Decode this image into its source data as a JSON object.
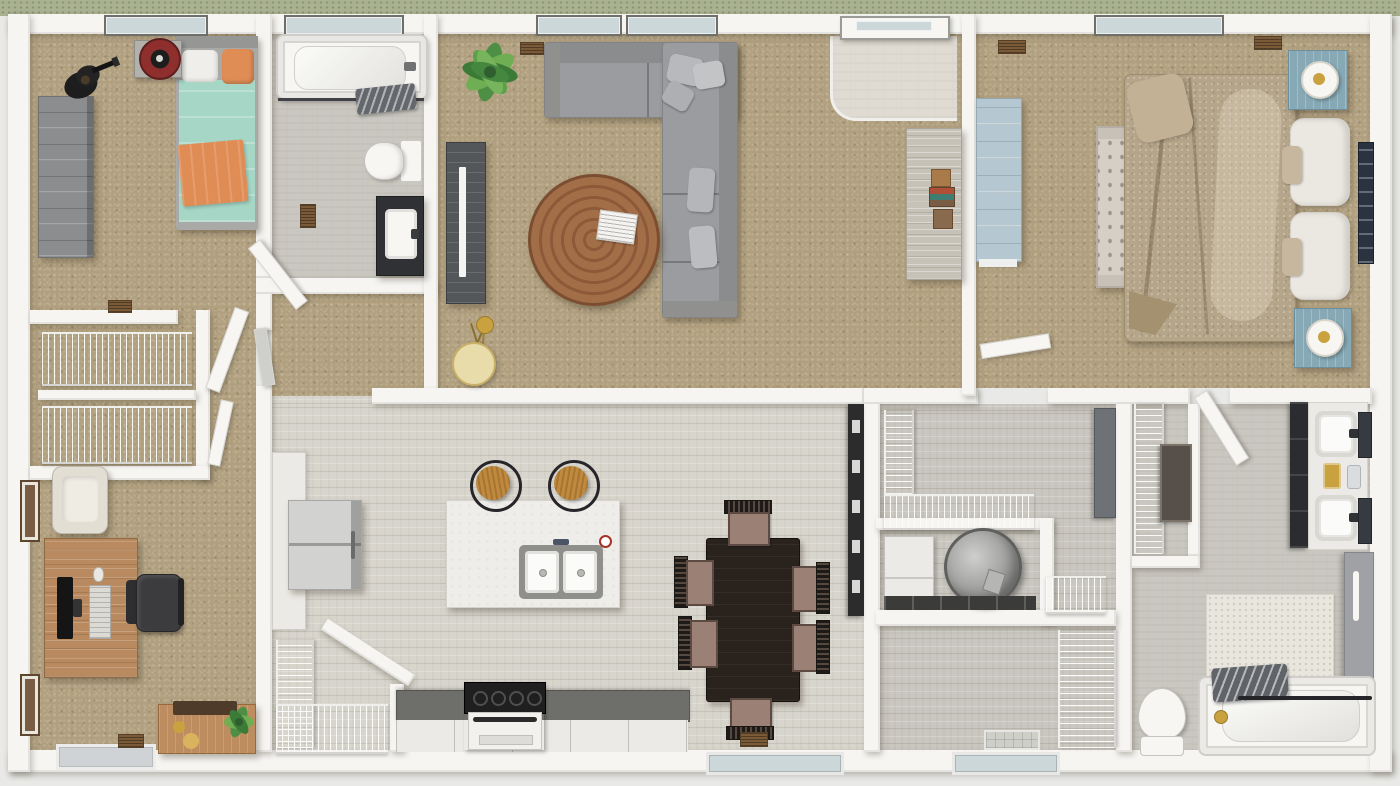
{
  "scene": {
    "kind": "3d-floor-plan-rendering",
    "view": "top-down",
    "note": "single-story residential floor plan, photorealistic dollhouse view, no visible text labels"
  },
  "palette": {
    "surround": "#e9e9e7",
    "grass": "#a9b190",
    "wall": "#f6f5f2",
    "wall_edge": "#c9c7c2",
    "carpet": "#b1a07f",
    "wood_light": "#d8d5cd",
    "wood_gray": "#cac7c0",
    "wood_entry": "#dfdbd2",
    "glass": "#ccd7d9",
    "vent": "#7b5a38",
    "sofa": "#9b9c9f",
    "sofa_back": "#8b8c8e",
    "pillow": "#b8b9bc",
    "coffee_table": "#a26e48",
    "coffee_table_ring": "#8d5a39",
    "tv_console": "#54575a",
    "tv": "#f4f4f2",
    "lamp_gold": "#c9a23f",
    "lamp_shade": "#e9dcab",
    "sofa_table": "#c6c2b8",
    "teal": "#a5d6c6",
    "orange": "#e08c55",
    "bed_frame": "#a9aaa8",
    "dresser_gray": "#8b8d8f",
    "speaker_red": "#8e2f2e",
    "bed_tan": "#b5a58a",
    "bed_fold": "#a3916f",
    "headboard_white": "#ebe8e1",
    "bench": "#d5cfc6",
    "nightstand": "#87a9b6",
    "dresser_blue": "#b5c8d1",
    "art_navy": "#2b3340",
    "island": "#efede9",
    "sink_rim": "#8f908c",
    "counter_dark": "#6e6f6a",
    "cabinet_white": "#eceae6",
    "stool_wood": "#c08a3e",
    "fridge": "#d2d2d0",
    "range_black": "#1f1f1f",
    "dining_table": "#2a231d",
    "chair_seat": "#9b8076",
    "chair_frame": "#3a322c",
    "dark_cabinet": "#2c2c2c",
    "appliance": "#eceae7",
    "heater": "#a7a7a5",
    "pan_dark": "#3b3b39",
    "gray_door": "#6e7176",
    "gray_panel": "#9fa1a4",
    "fixture_white": "#f7f6f3",
    "mat_white": "#e9e6de",
    "curtain": "#85898e",
    "desk_wood": "#b98a5f",
    "office_chair": "#3c3c3e",
    "armchair": "#e2ded4",
    "console_wood": "#bd8d60",
    "frame_brown": "#7a5b43",
    "plant_dark": "#3c7a38",
    "plant_light": "#6fae52"
  },
  "rooms": [
    {
      "id": "bedroom-2",
      "floor": "carpet",
      "contents": [
        "twin-bed-teal",
        "orange-pillows",
        "gray-dresser",
        "speaker-on-stand",
        "guitar",
        "window"
      ]
    },
    {
      "id": "hall-bathroom",
      "floor": "gray-wood",
      "contents": [
        "bathtub",
        "hanging-towels",
        "toilet",
        "dark-vanity-sink",
        "floor-vent",
        "door"
      ]
    },
    {
      "id": "hallway-closets",
      "floor": "carpet",
      "contents": [
        "wire-shelf-closet-upper",
        "wire-shelf-closet-lower",
        "doors"
      ]
    },
    {
      "id": "office-bedroom-3",
      "floor": "carpet",
      "contents": [
        "desk",
        "monitor",
        "keyboard",
        "office-chair",
        "armchair",
        "wall-frames",
        "console-with-plant",
        "door-mat",
        "floor-vent"
      ]
    },
    {
      "id": "living-room",
      "floor": "carpet",
      "contents": [
        "sectional-sofa",
        "round-coffee-table",
        "magazine",
        "tv-console",
        "tv",
        "potted-plant",
        "tripod-floor-lamp",
        "sofa-table",
        "entry-tile",
        "front-door",
        "windows"
      ]
    },
    {
      "id": "primary-bedroom",
      "floor": "carpet",
      "contents": [
        "king-bed-tan",
        "white-headboard-pillows",
        "tufted-bench",
        "blue-nightstands",
        "table-lamps",
        "blue-dresser",
        "wall-art",
        "window",
        "floor-vents",
        "door"
      ]
    },
    {
      "id": "kitchen-dining",
      "floor": "light-wood",
      "contents": [
        "island-double-sink",
        "bar-stools",
        "fridge",
        "range",
        "counter-run",
        "pantry-wire-shelves",
        "tall-dark-cabinet",
        "dining-table",
        "six-chairs",
        "back-door",
        "floor-vent"
      ]
    },
    {
      "id": "laundry-utility",
      "floor": "gray-wood",
      "contents": [
        "wire-shelves",
        "washer",
        "water-heater",
        "drain-pan",
        "gray-door-panel"
      ]
    },
    {
      "id": "mudroom-hall",
      "floor": "gray-wood",
      "contents": [
        "wire-shelf-closet",
        "exterior-door-threshold"
      ]
    },
    {
      "id": "primary-bathroom",
      "floor": "gray-wood",
      "contents": [
        "double-vanity",
        "two-sinks",
        "mirrors",
        "toiletry-tray",
        "walk-in-closet-wire-shelves",
        "closet-dresser",
        "bath-mat",
        "toilet",
        "tub-with-curtain",
        "gray-sliding-door",
        "door"
      ]
    }
  ]
}
